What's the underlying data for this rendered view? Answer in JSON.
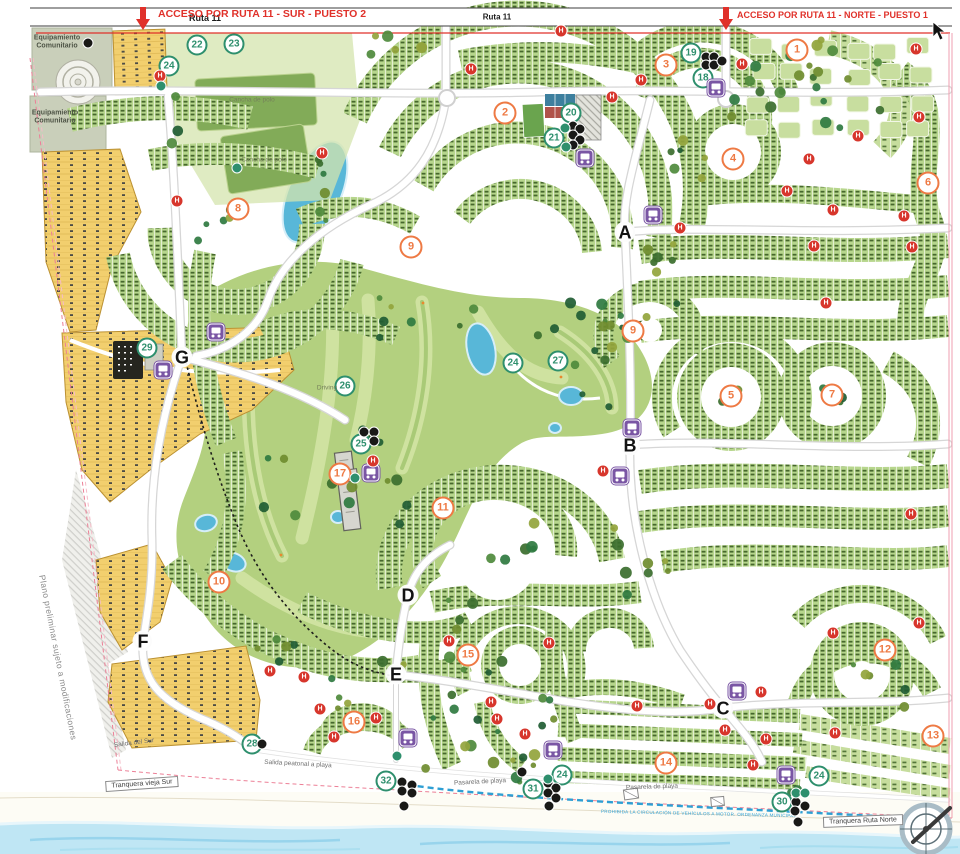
{
  "top": {
    "ruta11_left": "Ruta 11",
    "ruta11_center": "Ruta 11",
    "acceso_sur": "ACCESO POR RUTA 11 - SUR - PUESTO 2",
    "acceso_norte": "ACCESO POR RUTA 11 - NORTE - PUESTO 1"
  },
  "notes": {
    "preliminary": "Plano preliminar sujeto a modificaciones",
    "beach_rule": "PROHIBIDA LA CIRCULACIÓN DE VEHÍCULOS A MOTOR. ORDENANZA MUNICIPAL"
  },
  "labels": {
    "eq": [
      {
        "text": "Equipamiento Comunitario",
        "x": 57,
        "y": 43
      },
      {
        "text": "Equipamiento Comunitario",
        "x": 55,
        "y": 118
      }
    ],
    "area": [
      {
        "text": "Cancha de polo",
        "x": 252,
        "y": 100
      },
      {
        "text": "Cancha de polo",
        "x": 264,
        "y": 160
      },
      {
        "text": "Driving",
        "x": 327,
        "y": 388
      }
    ],
    "path": [
      {
        "text": "Salida del Sur",
        "x": 134,
        "y": 743,
        "r": -7
      },
      {
        "text": "Salida peatonal a playa",
        "x": 298,
        "y": 764,
        "r": 3
      },
      {
        "text": "Pasarela de playa",
        "x": 480,
        "y": 782,
        "r": -3
      },
      {
        "text": "Pasarela de playa",
        "x": 652,
        "y": 787,
        "r": -2
      }
    ],
    "boxed": [
      {
        "text": "Tranquera vieja Sur",
        "x": 142,
        "y": 784,
        "r": -4
      },
      {
        "text": "Tranquera Ruta Norte",
        "x": 863,
        "y": 821,
        "r": -2
      }
    ]
  },
  "markers": {
    "neighborhoods": [
      {
        "n": "1",
        "x": 797,
        "y": 50
      },
      {
        "n": "2",
        "x": 505,
        "y": 113
      },
      {
        "n": "3",
        "x": 666,
        "y": 65
      },
      {
        "n": "4",
        "x": 733,
        "y": 159
      },
      {
        "n": "5",
        "x": 731,
        "y": 396
      },
      {
        "n": "6",
        "x": 928,
        "y": 183
      },
      {
        "n": "7",
        "x": 832,
        "y": 395
      },
      {
        "n": "8",
        "x": 238,
        "y": 209
      },
      {
        "n": "9",
        "x": 411,
        "y": 247
      },
      {
        "n": "9",
        "x": 633,
        "y": 331
      },
      {
        "n": "10",
        "x": 219,
        "y": 582
      },
      {
        "n": "11",
        "x": 443,
        "y": 508
      },
      {
        "n": "12",
        "x": 885,
        "y": 650
      },
      {
        "n": "13",
        "x": 933,
        "y": 736
      },
      {
        "n": "14",
        "x": 666,
        "y": 763
      },
      {
        "n": "15",
        "x": 468,
        "y": 655
      },
      {
        "n": "16",
        "x": 354,
        "y": 722
      },
      {
        "n": "17",
        "x": 340,
        "y": 474
      }
    ],
    "amenities": [
      {
        "n": "18",
        "x": 703,
        "y": 78
      },
      {
        "n": "19",
        "x": 691,
        "y": 53
      },
      {
        "n": "20",
        "x": 571,
        "y": 113
      },
      {
        "n": "21",
        "x": 554,
        "y": 138
      },
      {
        "n": "22",
        "x": 197,
        "y": 45
      },
      {
        "n": "23",
        "x": 234,
        "y": 44
      },
      {
        "n": "24",
        "x": 169,
        "y": 66
      },
      {
        "n": "24",
        "x": 513,
        "y": 363
      },
      {
        "n": "24",
        "x": 562,
        "y": 775
      },
      {
        "n": "24",
        "x": 819,
        "y": 776
      },
      {
        "n": "25",
        "x": 361,
        "y": 444
      },
      {
        "n": "26",
        "x": 345,
        "y": 386
      },
      {
        "n": "27",
        "x": 558,
        "y": 361
      },
      {
        "n": "28",
        "x": 252,
        "y": 744
      },
      {
        "n": "29",
        "x": 147,
        "y": 348
      },
      {
        "n": "30",
        "x": 782,
        "y": 802
      },
      {
        "n": "31",
        "x": 533,
        "y": 789
      },
      {
        "n": "32",
        "x": 386,
        "y": 781
      }
    ],
    "junctions": [
      {
        "n": "A",
        "x": 625,
        "y": 232
      },
      {
        "n": "B",
        "x": 630,
        "y": 445
      },
      {
        "n": "C",
        "x": 723,
        "y": 708
      },
      {
        "n": "D",
        "x": 408,
        "y": 595
      },
      {
        "n": "E",
        "x": 396,
        "y": 674
      },
      {
        "n": "F",
        "x": 143,
        "y": 641
      },
      {
        "n": "G",
        "x": 182,
        "y": 357
      }
    ],
    "bus_stops": [
      [
        716,
        88
      ],
      [
        653,
        215
      ],
      [
        585,
        158
      ],
      [
        216,
        332
      ],
      [
        163,
        370
      ],
      [
        371,
        473
      ],
      [
        632,
        428
      ],
      [
        620,
        476
      ],
      [
        408,
        738
      ],
      [
        553,
        750
      ],
      [
        737,
        691
      ],
      [
        786,
        775
      ]
    ],
    "hydrant_letter": "H",
    "hydrants": [
      [
        561,
        31
      ],
      [
        160,
        76
      ],
      [
        322,
        153
      ],
      [
        177,
        201
      ],
      [
        471,
        69
      ],
      [
        641,
        80
      ],
      [
        612,
        97
      ],
      [
        742,
        64
      ],
      [
        916,
        49
      ],
      [
        919,
        117
      ],
      [
        858,
        136
      ],
      [
        809,
        159
      ],
      [
        787,
        191
      ],
      [
        833,
        210
      ],
      [
        904,
        216
      ],
      [
        680,
        228
      ],
      [
        814,
        246
      ],
      [
        912,
        247
      ],
      [
        826,
        303
      ],
      [
        373,
        461
      ],
      [
        603,
        471
      ],
      [
        911,
        514
      ],
      [
        270,
        671
      ],
      [
        304,
        677
      ],
      [
        320,
        709
      ],
      [
        376,
        718
      ],
      [
        334,
        737
      ],
      [
        449,
        641
      ],
      [
        549,
        643
      ],
      [
        491,
        702
      ],
      [
        497,
        719
      ],
      [
        525,
        734
      ],
      [
        637,
        706
      ],
      [
        833,
        633
      ],
      [
        919,
        623
      ],
      [
        761,
        692
      ],
      [
        710,
        704
      ],
      [
        725,
        730
      ],
      [
        766,
        739
      ],
      [
        753,
        765
      ],
      [
        835,
        733
      ]
    ],
    "poi_black": [
      [
        364,
        432
      ],
      [
        374,
        432
      ],
      [
        374,
        441
      ],
      [
        573,
        126
      ],
      [
        580,
        129
      ],
      [
        573,
        135
      ],
      [
        580,
        140
      ],
      [
        573,
        145
      ],
      [
        706,
        57
      ],
      [
        714,
        57
      ],
      [
        706,
        65
      ],
      [
        714,
        65
      ],
      [
        722,
        61
      ],
      [
        88,
        43
      ],
      [
        262,
        744
      ],
      [
        548,
        783
      ],
      [
        556,
        788
      ],
      [
        548,
        793
      ],
      [
        556,
        798
      ],
      [
        549,
        806
      ],
      [
        522,
        772
      ],
      [
        402,
        782
      ],
      [
        412,
        785
      ],
      [
        402,
        791
      ],
      [
        412,
        793
      ],
      [
        404,
        806
      ],
      [
        796,
        802
      ],
      [
        805,
        806
      ],
      [
        795,
        811
      ],
      [
        798,
        822
      ]
    ],
    "poi_teal": [
      [
        565,
        128
      ],
      [
        566,
        147
      ],
      [
        355,
        478
      ],
      [
        161,
        86
      ],
      [
        397,
        756
      ],
      [
        548,
        779
      ],
      [
        796,
        793
      ],
      [
        805,
        793
      ],
      [
        237,
        168
      ]
    ]
  },
  "colors": {
    "accent_red": "#e0312a",
    "neighborhood_orange": "#ee7a44",
    "amenity_green": "#2e8f6d",
    "bus_purple": "#7a56a4",
    "hydrant_red": "#d7362c",
    "lot_green": "#b7d68d",
    "golf_green": "#b3d07f",
    "lot_yellow": "#f2cf6e",
    "water_blue": "#bfe6f4",
    "bike_path_blue": "#2e9fd4"
  }
}
